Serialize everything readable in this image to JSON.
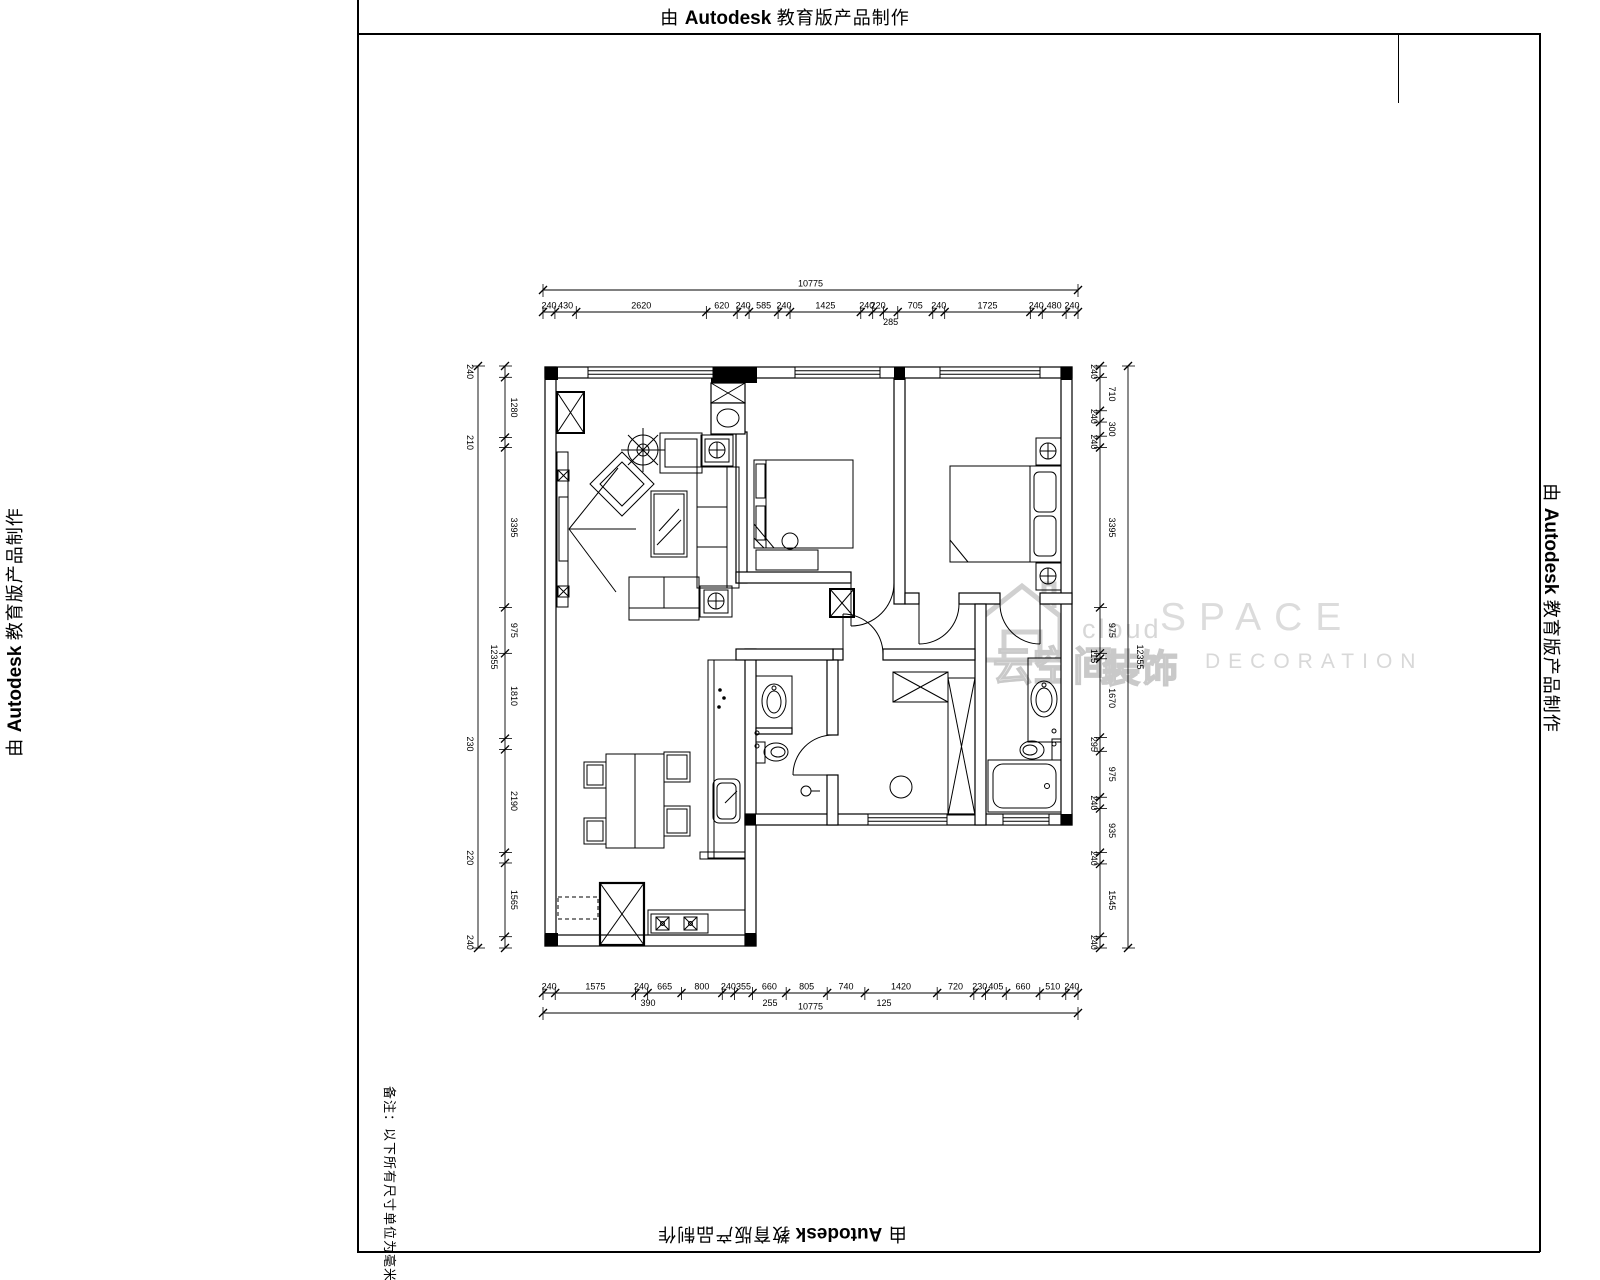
{
  "stamp": {
    "prefix": "由",
    "brand": "Autodesk",
    "suffix": "教育版产品制作"
  },
  "note_text": "备注：以下所有尺寸单位为毫米",
  "watermark": {
    "cloud": "cloud",
    "space": "SPACE",
    "cn_name": "云空间",
    "cn_sub": "装饰",
    "en_sub": "DECORATION"
  },
  "dimensions": {
    "top": {
      "total": "10775",
      "segments": [
        {
          "v": "240"
        },
        {
          "v": "430"
        },
        {
          "v": "2620"
        },
        {
          "v": "620"
        },
        {
          "v": "240"
        },
        {
          "v": "585"
        },
        {
          "v": "240"
        },
        {
          "v": "1425"
        },
        {
          "v": "240"
        },
        {
          "v": "220"
        },
        {
          "v": "285",
          "below": true
        },
        {
          "v": "705"
        },
        {
          "v": "240"
        },
        {
          "v": "1725"
        },
        {
          "v": "240"
        },
        {
          "v": "480"
        },
        {
          "v": "240"
        }
      ]
    },
    "bottom": {
      "total": "10775",
      "segments": [
        {
          "v": "240"
        },
        {
          "v": "1575"
        },
        {
          "v": "240"
        },
        {
          "v": "665"
        },
        {
          "v": "800"
        },
        {
          "v": "240"
        },
        {
          "v": "355"
        },
        {
          "v": "660"
        },
        {
          "v": "805"
        },
        {
          "v": "740"
        },
        {
          "v": "1420"
        },
        {
          "v": "720"
        },
        {
          "v": "230"
        },
        {
          "v": "405"
        },
        {
          "v": "660"
        },
        {
          "v": "510"
        },
        {
          "v": "240"
        }
      ],
      "sub_labels": [
        "390",
        "255",
        "125"
      ]
    },
    "left": {
      "total": "12355",
      "segments": [
        {
          "v": "240"
        },
        {
          "v": "1280"
        },
        {
          "v": "210"
        },
        {
          "v": "3395"
        },
        {
          "v": "975"
        },
        {
          "v": "1810"
        },
        {
          "v": "230"
        },
        {
          "v": "2190"
        },
        {
          "v": "220"
        },
        {
          "v": "1565"
        },
        {
          "v": "240"
        }
      ]
    },
    "right": {
      "total": "12355",
      "segments": [
        {
          "v": "240"
        },
        {
          "v": "710"
        },
        {
          "v": "240"
        },
        {
          "v": "300"
        },
        {
          "v": "240"
        },
        {
          "v": "3395"
        },
        {
          "v": "975"
        },
        {
          "v": "115"
        },
        {
          "v": "1670"
        },
        {
          "v": "295"
        },
        {
          "v": "975"
        },
        {
          "v": "240"
        },
        {
          "v": "935"
        },
        {
          "v": "240"
        },
        {
          "v": "1545"
        },
        {
          "v": "240"
        }
      ]
    }
  }
}
